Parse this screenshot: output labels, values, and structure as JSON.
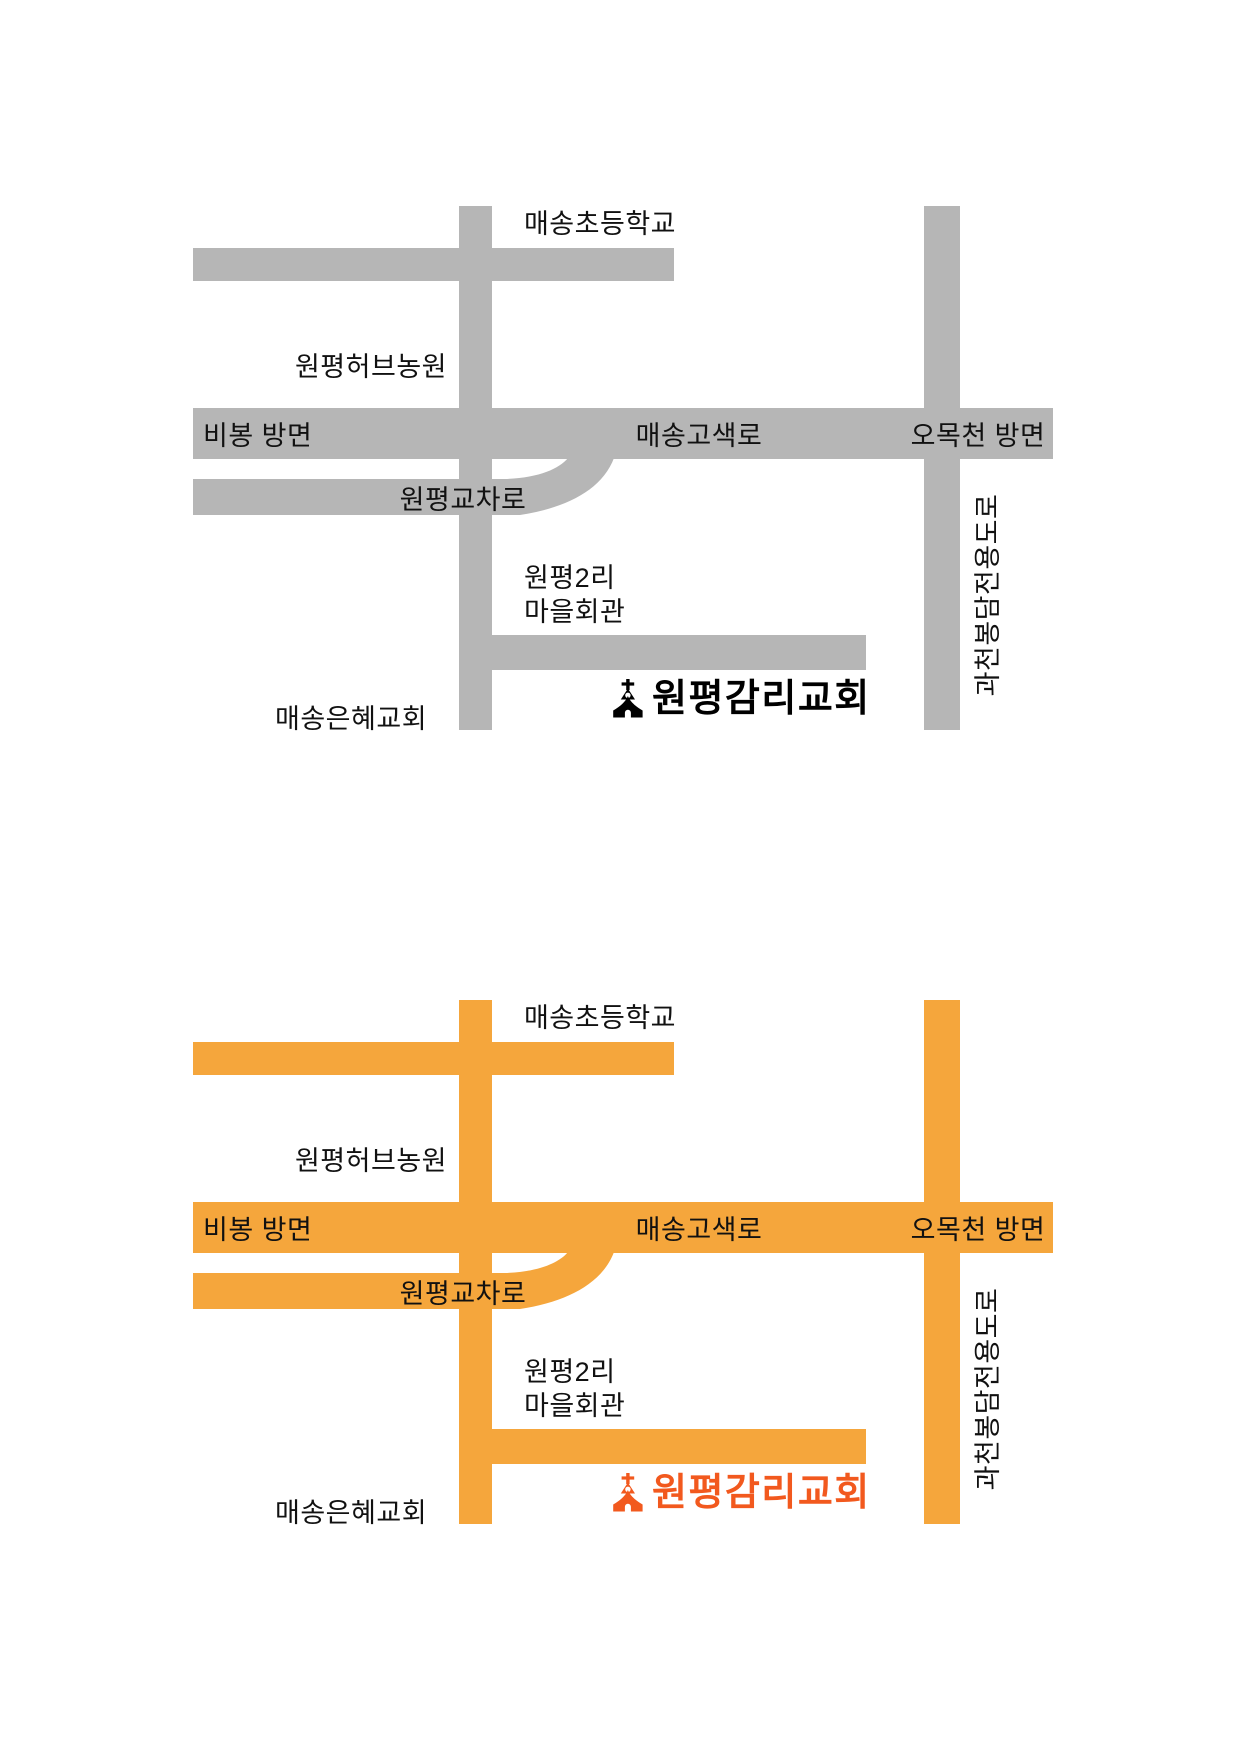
{
  "page": {
    "background_color": "#ffffff",
    "description": "Two stacked direction maps to Wonpyeong Methodist Church, gray version on top and orange version below"
  },
  "maps": {
    "gray": {
      "road_color": "#B6B6B6",
      "label_color": "#111111",
      "church_color": "#000000",
      "labels": {
        "school": "매송초등학교",
        "herb_farm": "원평허브농원",
        "bibong": "비봉 방면",
        "gosaek_road": "매송고색로",
        "omokcheon": "오목천 방면",
        "intersection": "원평교차로",
        "village_line1": "원평2리",
        "village_line2": "마을회관",
        "grace_church": "매송은혜교회",
        "expressway": "과천봉담전용도로",
        "church": "원평감리교회"
      }
    },
    "orange": {
      "road_color": "#F5A63C",
      "label_color": "#111111",
      "church_color": "#F2591E",
      "labels": {
        "school": "매송초등학교",
        "herb_farm": "원평허브농원",
        "bibong": "비봉 방면",
        "gosaek_road": "매송고색로",
        "omokcheon": "오목천 방면",
        "intersection": "원평교차로",
        "village_line1": "원평2리",
        "village_line2": "마을회관",
        "grace_church": "매송은혜교회",
        "expressway": "과천봉담전용도로",
        "church": "원평감리교회"
      }
    }
  }
}
